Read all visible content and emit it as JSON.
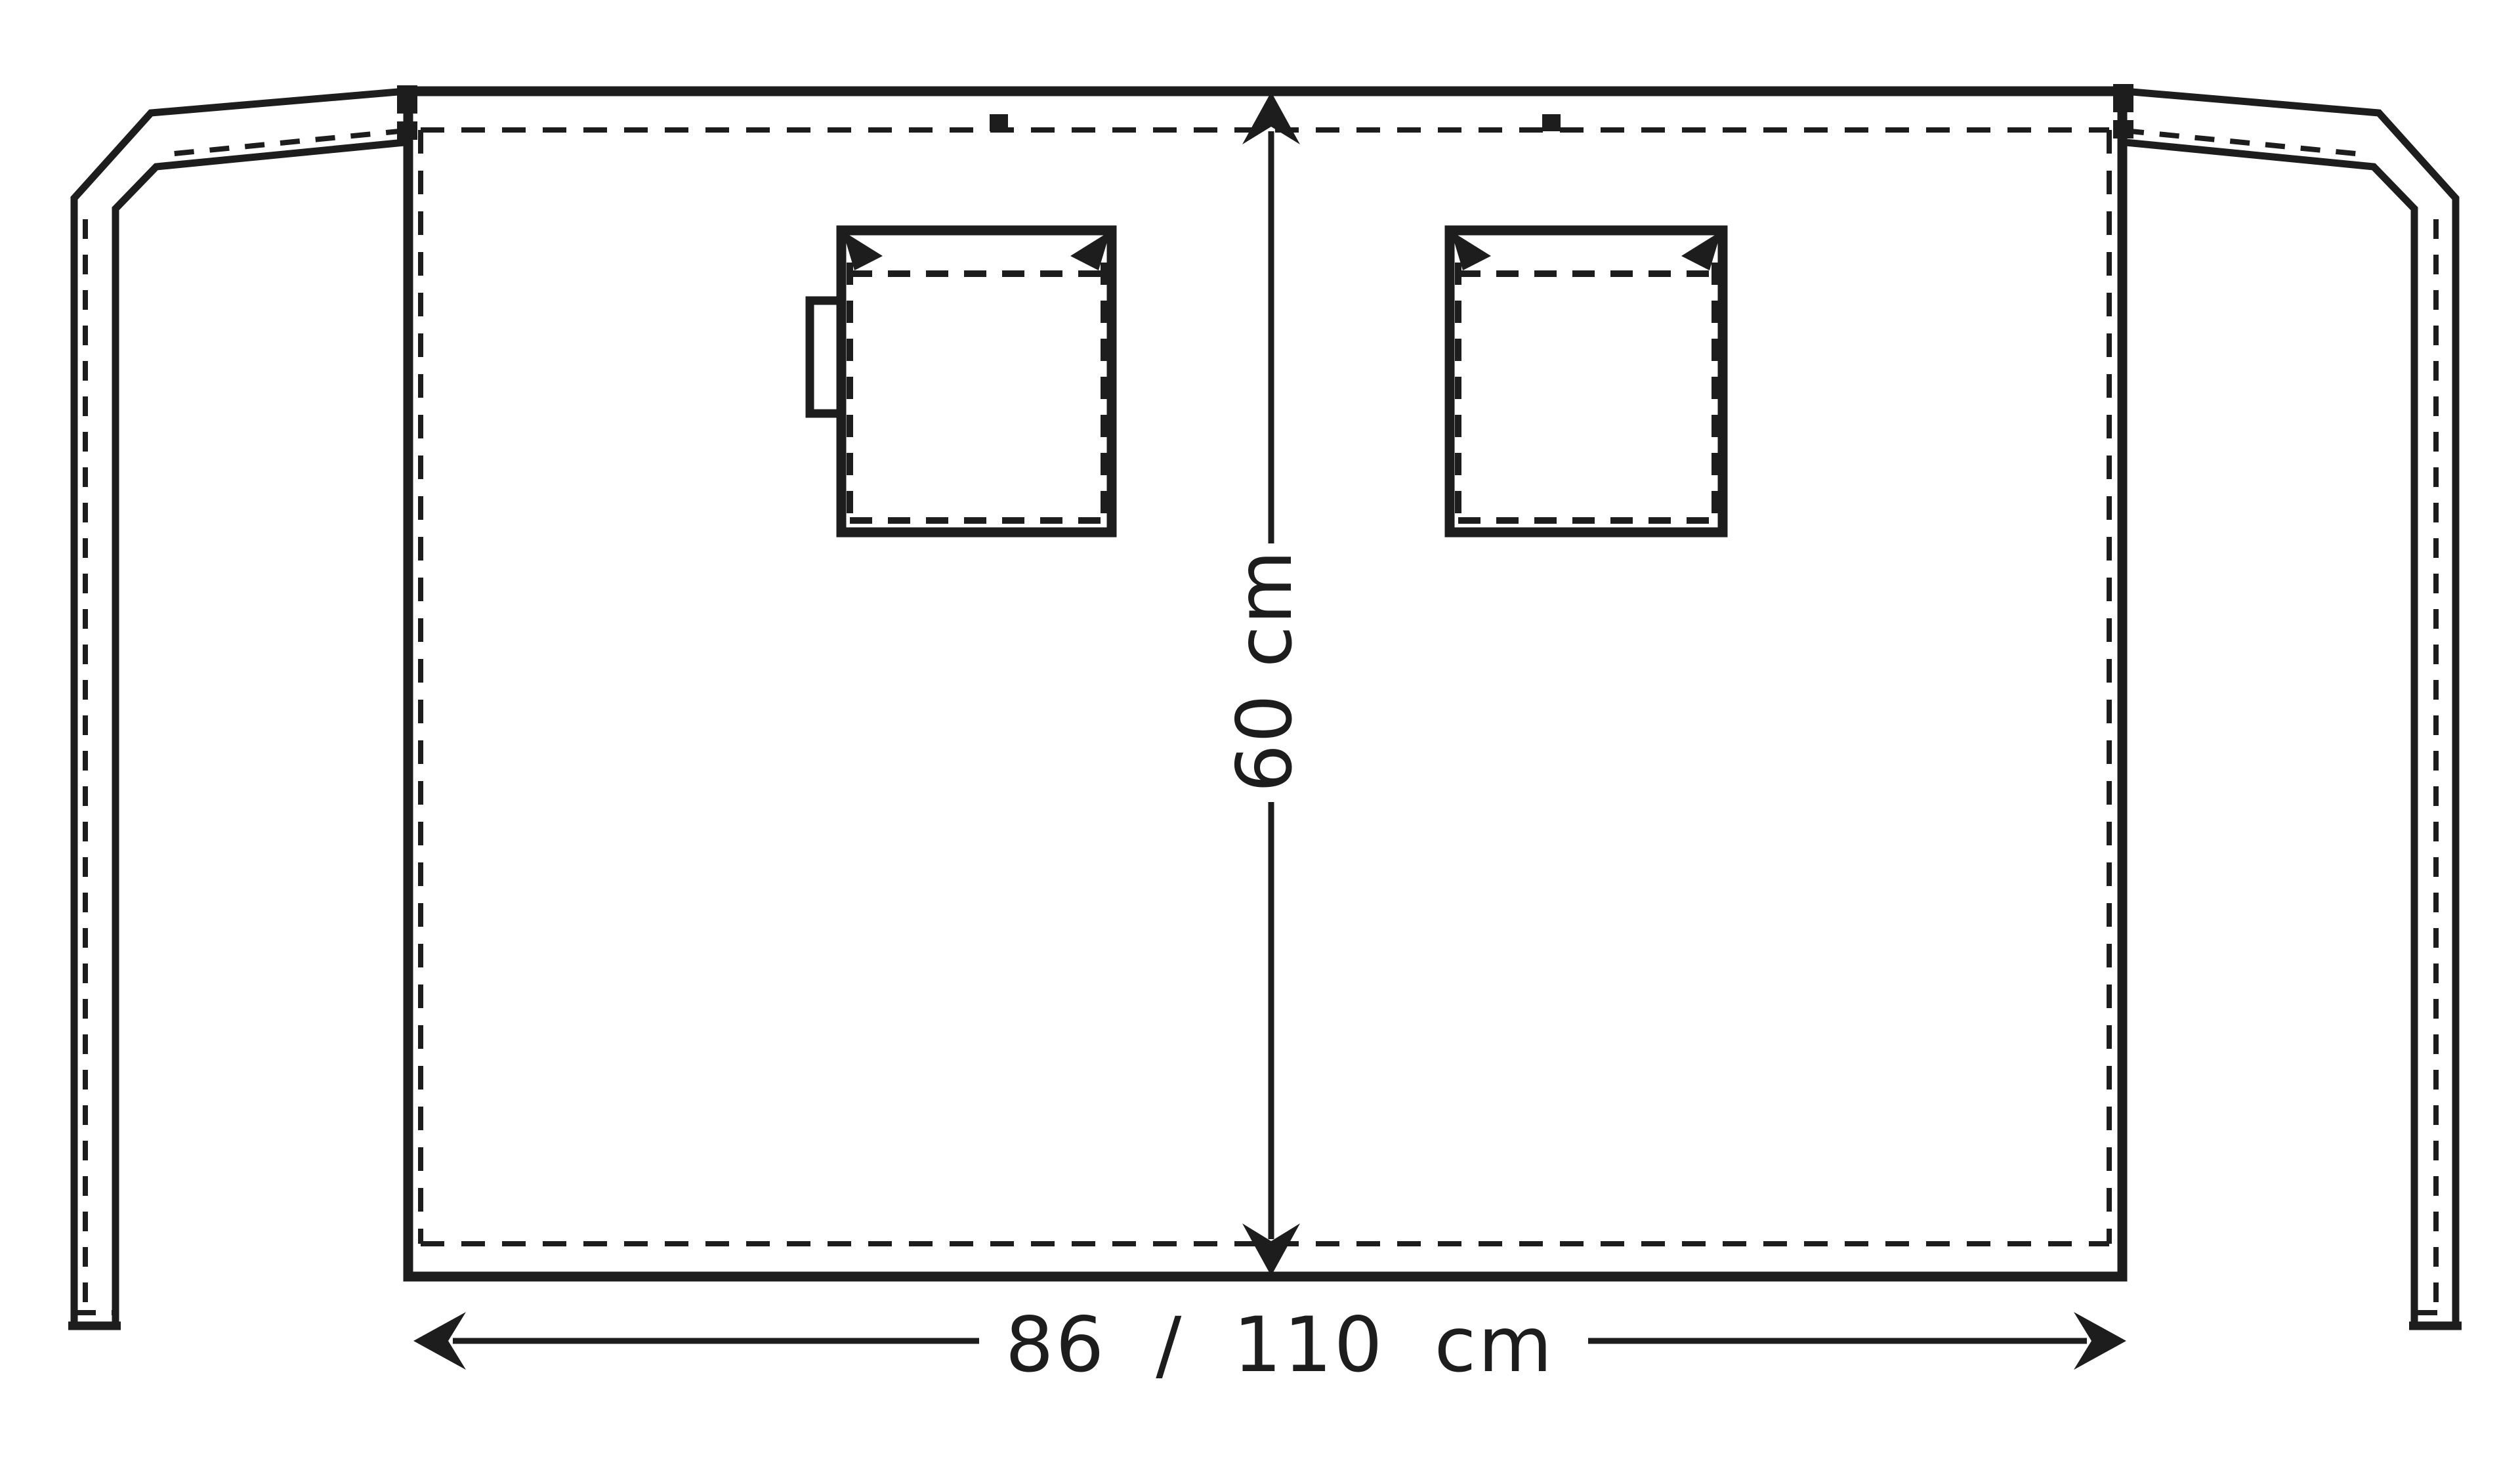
{
  "colors": {
    "line": "#1d1d1d",
    "background": "#ffffff"
  },
  "dimensions": {
    "height_label": "60 cm",
    "width_label": "86 / 110 cm"
  }
}
